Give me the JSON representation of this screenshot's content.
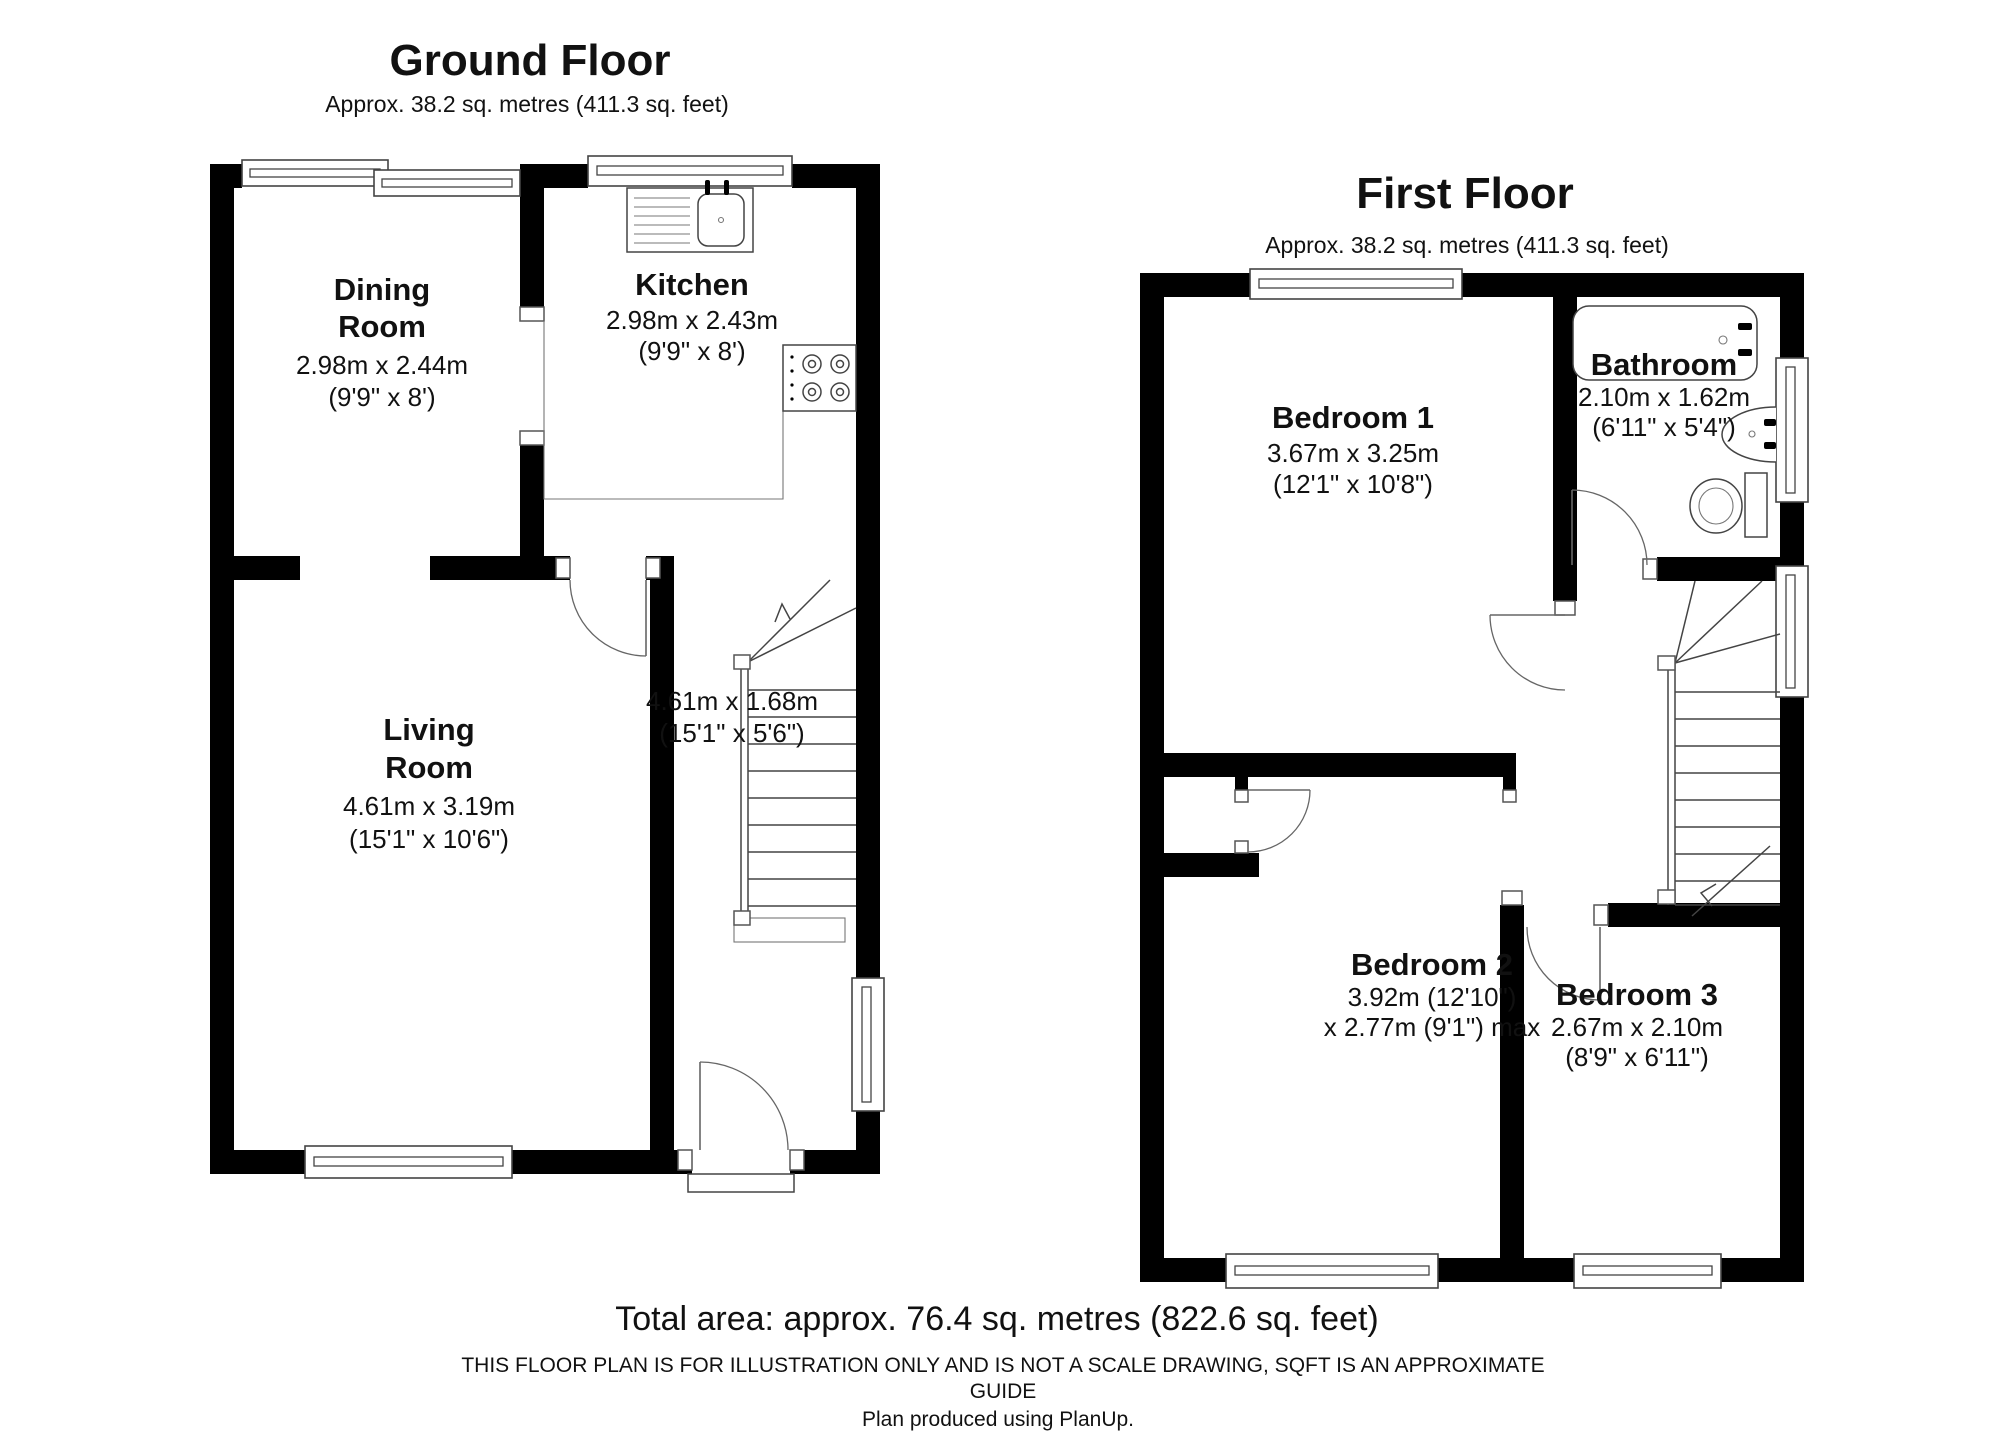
{
  "ground_floor": {
    "title": "Ground Floor",
    "subtitle": "Approx. 38.2 sq. metres (411.3 sq. feet)",
    "rooms": {
      "dining": {
        "name_lines": [
          "Dining",
          "Room"
        ],
        "dim_lines": [
          "2.98m x 2.44m",
          "(9'9\" x 8')"
        ]
      },
      "kitchen": {
        "name_lines": [
          "Kitchen"
        ],
        "dim_lines": [
          "2.98m x 2.43m",
          "(9'9\" x 8')"
        ]
      },
      "living": {
        "name_lines": [
          "Living",
          "Room"
        ],
        "dim_lines": [
          "4.61m x 3.19m",
          "(15'1\" x 10'6\")"
        ]
      },
      "hall": {
        "name_lines": [],
        "dim_lines": [
          "4.61m x 1.68m",
          "(15'1\" x 5'6\")"
        ]
      }
    }
  },
  "first_floor": {
    "title": "First Floor",
    "subtitle": "Approx. 38.2 sq. metres (411.3 sq. feet)",
    "rooms": {
      "bedroom1": {
        "name_lines": [
          "Bedroom 1"
        ],
        "dim_lines": [
          "3.67m x 3.25m",
          "(12'1\" x 10'8\")"
        ]
      },
      "bathroom": {
        "name_lines": [
          "Bathroom"
        ],
        "dim_lines": [
          "2.10m x 1.62m",
          "(6'11\" x 5'4\")"
        ]
      },
      "bedroom2": {
        "name_lines": [
          "Bedroom 2"
        ],
        "dim_lines": [
          "3.92m (12'10\")",
          "x 2.77m (9'1\") max"
        ]
      },
      "bedroom3": {
        "name_lines": [
          "Bedroom 3"
        ],
        "dim_lines": [
          "2.67m x 2.10m",
          "(8'9\" x 6'11\")"
        ]
      }
    }
  },
  "footer": {
    "total": "Total area: approx. 76.4 sq. metres (822.6 sq. feet)",
    "disclaimer_line1": "THIS FLOOR PLAN IS FOR ILLUSTRATION ONLY AND IS NOT A SCALE DRAWING, SQFT IS AN APPROXIMATE",
    "disclaimer_line2": "GUIDE",
    "credit": "Plan produced using PlanUp."
  }
}
